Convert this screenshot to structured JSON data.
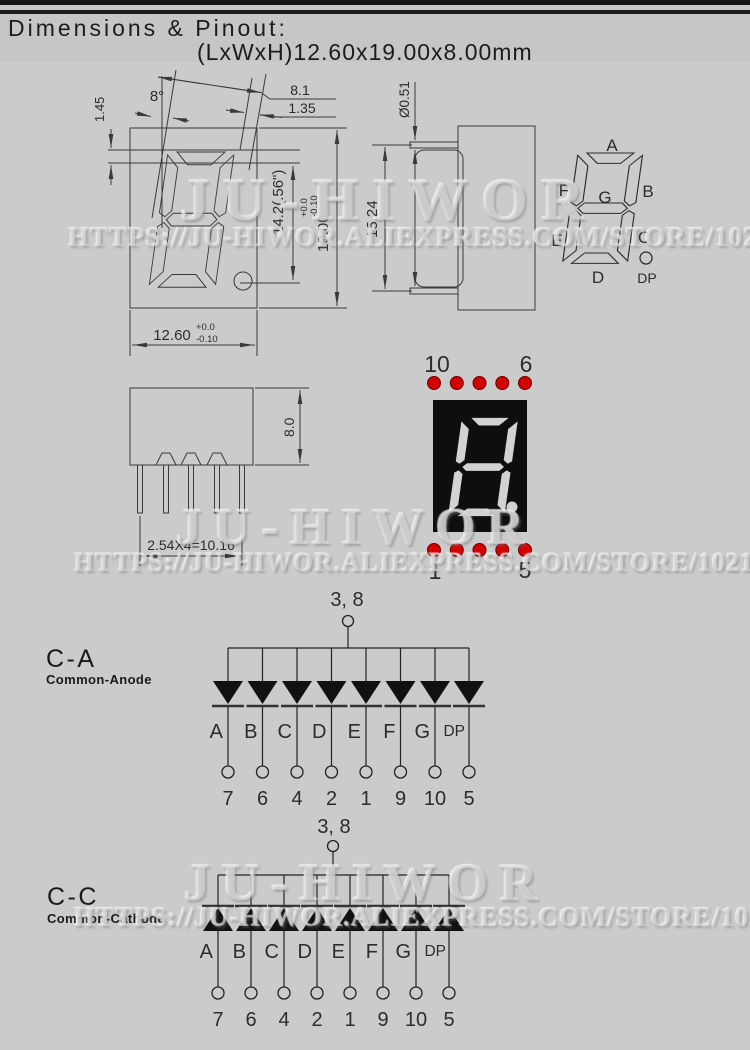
{
  "header": {
    "title": "Dimensions & Pinout:",
    "subtitle": "(LxWxH)12.60x19.00x8.00mm"
  },
  "watermark": {
    "brand": "JU-HIWOR",
    "url": "HTTPS://JU-HIWOR.ALIEXPRESS.COM/STORE/1021664"
  },
  "front_view": {
    "dim_digit_width": "8.1",
    "dim_segment_width": "1.35",
    "dim_top_margin": "1.45",
    "slant_angle": "8°",
    "dim_digit_height": "14.2(.56\")",
    "dim_height": "19.00",
    "dim_height_tol_plus": "+0.0",
    "dim_height_tol_minus": "-0.10",
    "dim_width": "12.60",
    "dim_width_tol_plus": "+0.0",
    "dim_width_tol_minus": "-0.10"
  },
  "side_view": {
    "dim_pin_diameter": "Ø0.51",
    "dim_row_spacing": "15.24"
  },
  "segment_diagram": {
    "labels": [
      "A",
      "B",
      "C",
      "D",
      "E",
      "F",
      "G",
      "DP"
    ]
  },
  "bottom_view": {
    "dim_depth": "8.0",
    "dim_pin_pitch": "2.54X4=10.16"
  },
  "photo": {
    "pin_top_left": "10",
    "pin_top_right": "6",
    "pin_bottom_left": "1",
    "pin_bottom_right": "5",
    "dot_color": "#d40000"
  },
  "common_anode": {
    "title": "C-A",
    "subtitle": "Common-Anode",
    "common_pins": "3, 8",
    "segments": [
      "A",
      "B",
      "C",
      "D",
      "E",
      "F",
      "G",
      "DP"
    ],
    "pins": [
      "7",
      "6",
      "4",
      "2",
      "1",
      "9",
      "10",
      "5"
    ]
  },
  "common_cathode": {
    "title": "C-C",
    "subtitle": "Common-Cathode",
    "common_pins": "3, 8",
    "segments": [
      "A",
      "B",
      "C",
      "D",
      "E",
      "F",
      "G",
      "DP"
    ],
    "pins": [
      "7",
      "6",
      "4",
      "2",
      "1",
      "9",
      "10",
      "5"
    ]
  }
}
